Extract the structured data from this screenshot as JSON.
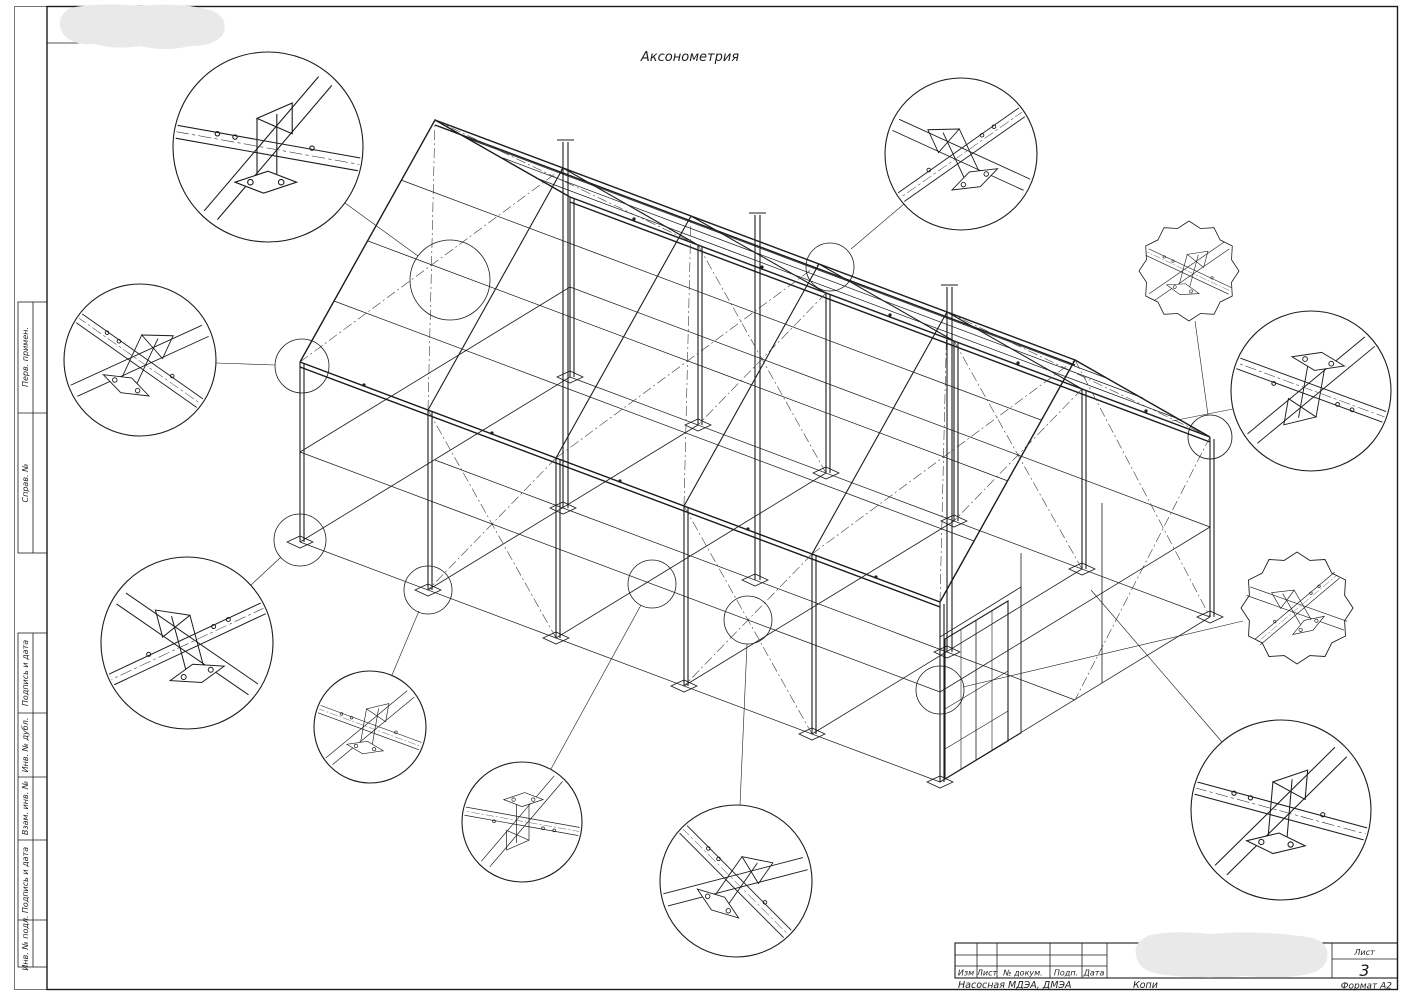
{
  "sheet": {
    "title": "Аксонометрия",
    "doc_name": "Насосная МДЭА, ДМЭА",
    "copied_label": "Копи",
    "format_label": "Формат А2",
    "sheet_label": "Лист",
    "sheet_number": "3",
    "margin_labels": [
      "Перв. примен.",
      "Справ. №",
      "Подпись и дата",
      "Инв. № дубл.",
      "Взам. инв. №",
      "Подпись и дата",
      "Инв. № подл."
    ],
    "titleblock_headers": [
      "Изм",
      "Лист",
      "№ докум.",
      "Подп.",
      "Дата"
    ],
    "colors": {
      "ink": "#1c1c1c",
      "redaction": "#e9e9e9",
      "paper": "#ffffff"
    }
  }
}
